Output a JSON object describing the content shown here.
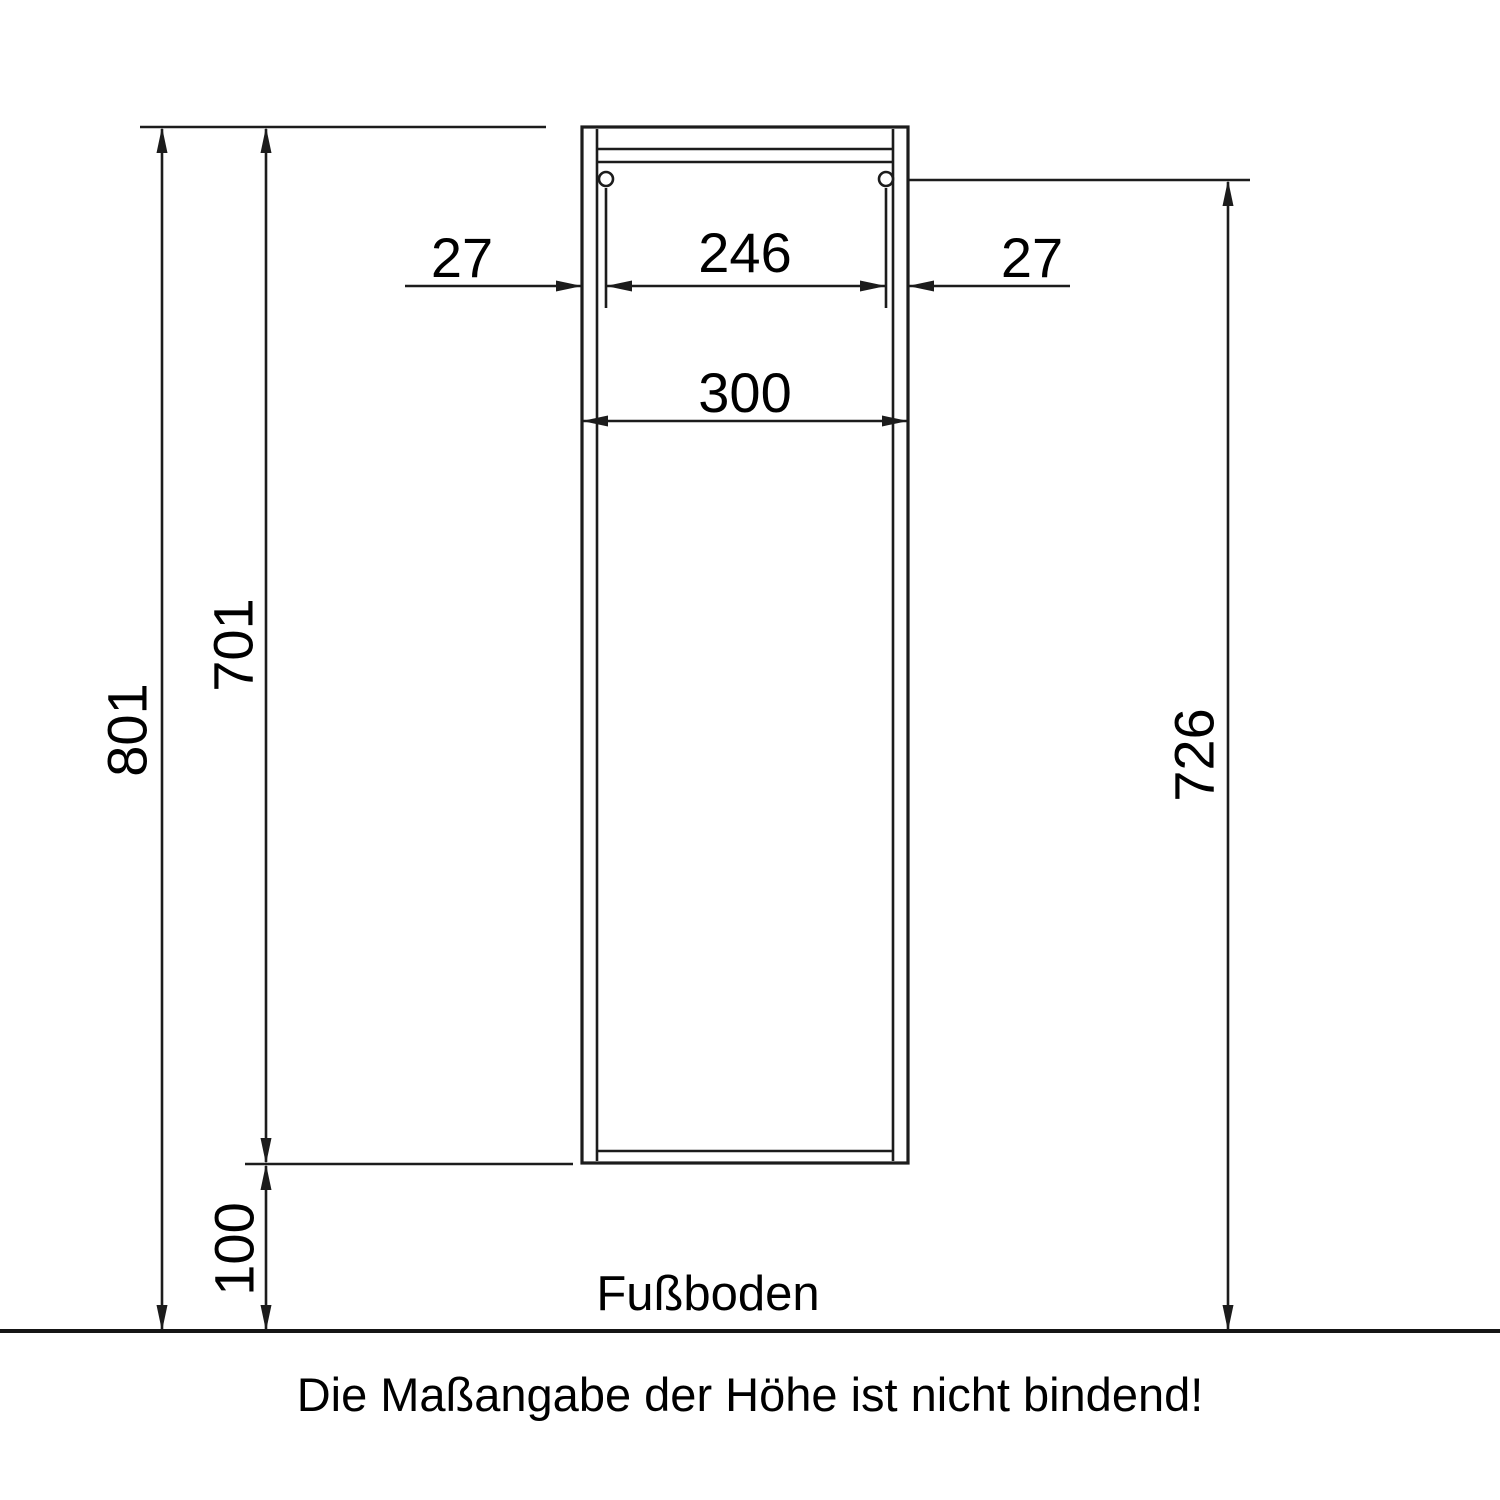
{
  "drawing": {
    "title": "cabinet-dimension-drawing",
    "dims": {
      "left_offset": "27",
      "inner_width": "246",
      "right_offset": "27",
      "outer_width": "300",
      "overall_height": "801",
      "body_height": "701",
      "floor_clearance": "100",
      "mount_height": "726"
    },
    "labels": {
      "floor": "Fußboden",
      "note": "Die Maßangabe der Höhe ist nicht bindend!"
    },
    "colors": {
      "line": "#1c1c1c",
      "text": "#000000",
      "background": "#ffffff"
    }
  }
}
